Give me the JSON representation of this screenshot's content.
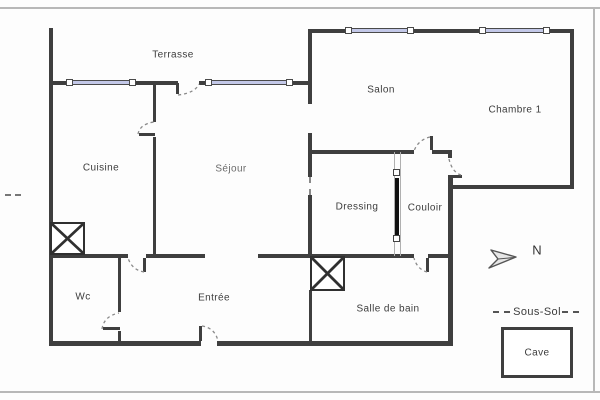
{
  "floorplan": {
    "rooms": {
      "terrasse": "Terrasse",
      "salon": "Salon",
      "chambre1": "Chambre 1",
      "cuisine": "Cuisine",
      "sejour": "Séjour",
      "dressing": "Dressing",
      "couloir": "Couloir",
      "wc": "Wc",
      "entree": "Entrée",
      "salle_de_bain": "Salle de bain"
    },
    "compass": {
      "north_label": "N"
    },
    "legend": {
      "basement": "Sous-Sol",
      "cellar": "Cave"
    },
    "colors": {
      "wall": "#3f3f3f",
      "window_glass": "#c3c8e8",
      "door_arc": "#8a8a8a",
      "text": "#3c3c3c",
      "frame_line": "#b8b8b8",
      "sliding_panel": "#111111"
    }
  }
}
